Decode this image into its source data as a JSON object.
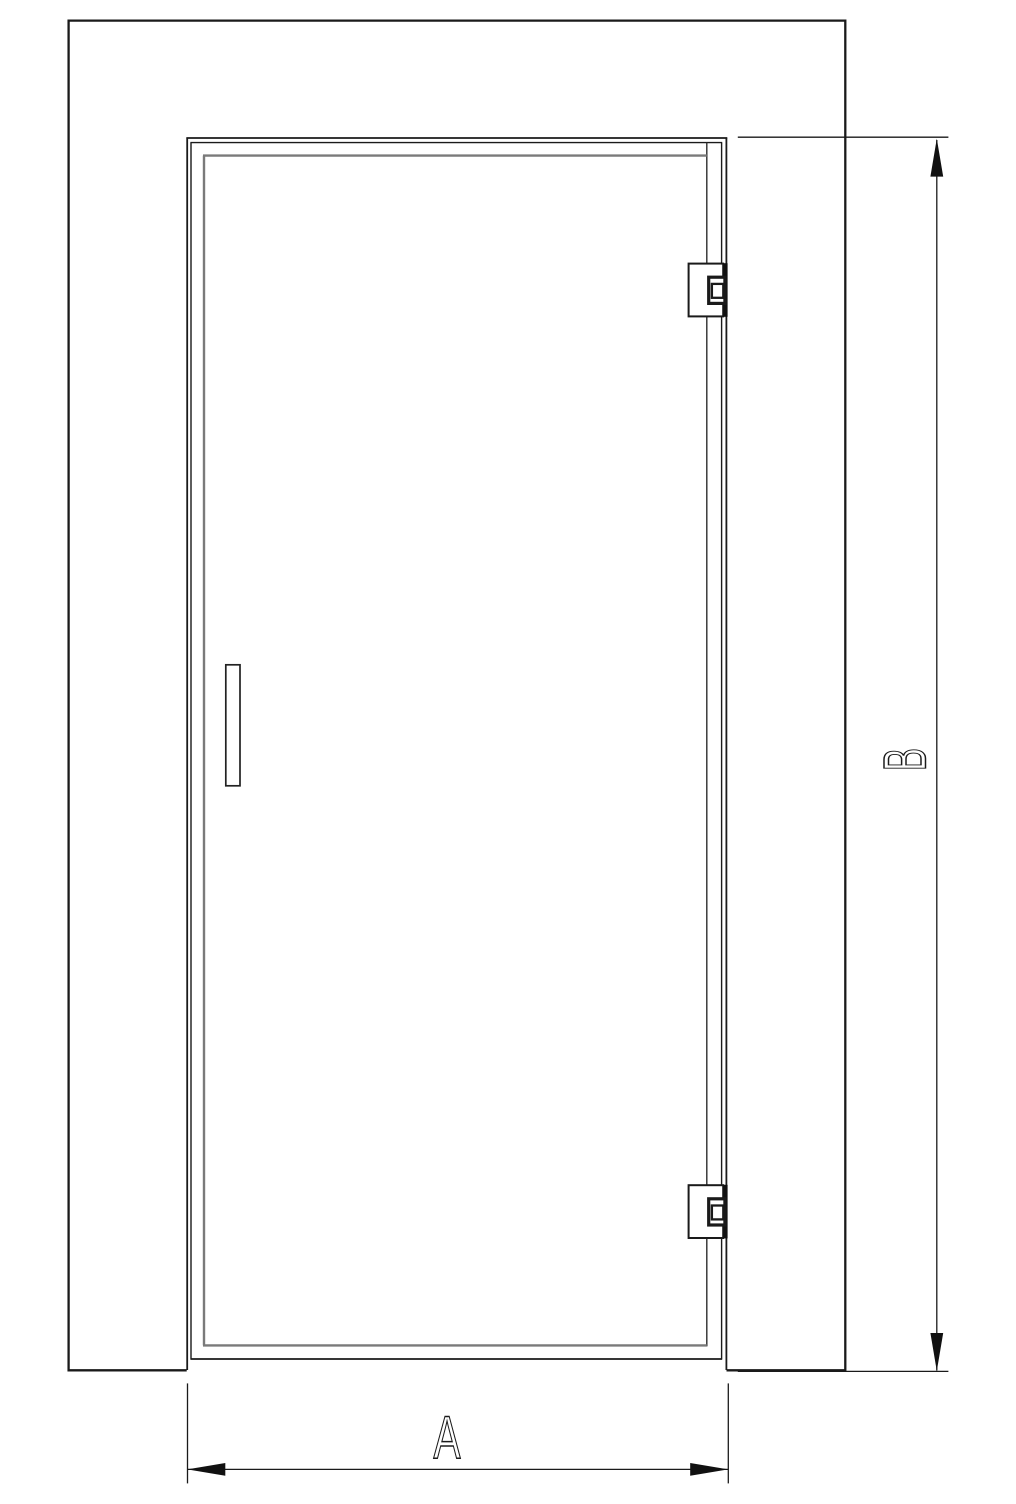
{
  "diagram": {
    "type": "technical-drawing-door-elevation",
    "labels": {
      "width_label": "A",
      "height_label": "B"
    },
    "colors": {
      "line": "#1a1a1a",
      "panel_line": "#7a7a7a",
      "dimension": "#1a1a1a",
      "arrow_fill": "#111111",
      "background": "#ffffff"
    }
  }
}
